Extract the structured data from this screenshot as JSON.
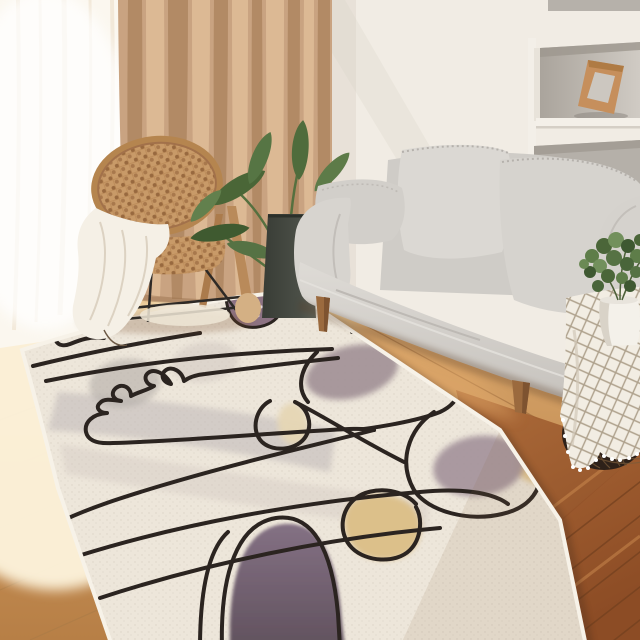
{
  "scene": {
    "type": "living-room photograph",
    "subject": "cream abstract line-art area rug in a bright scandinavian living room",
    "lighting": "warm daylight from a window on the left"
  },
  "palette": {
    "wall": "#f1ece4",
    "niche_interior": "#b5b0a9",
    "frame_wood": "#c68f5c",
    "sheer_curtain": "#fbf7ef",
    "curtain_base": "#c9a381",
    "curtain_fold_dark": "#b08863",
    "curtain_fold_light": "#e0bd98",
    "floor_light_wood": "#cf9e66",
    "floor_sunlit": "#f9ebcb",
    "floor_red_wood": "#9e5c30",
    "rug_base": "#ede6da",
    "rug_line_black": "#2b2420",
    "rug_gray_band": "#beb6b6",
    "rug_mauve": "#9e8d94",
    "rug_purple_dome": "#75646f",
    "rug_yellow": "#dcc08a",
    "rug_cream_oval": "#e6d6b4",
    "sofa_fabric": "#d6d3ce",
    "sofa_leg_wood": "#9b6a3e",
    "blanket_white": "#f5f0e6",
    "rattan": "#c89a68",
    "plant_green": "#4f6c3c",
    "planter_dark": "#43473f",
    "gingham_cloth": "#f2ede3",
    "gingham_line": "#8f7d64",
    "basket_dark": "#2e2119",
    "pot_white": "#f4f1ea"
  },
  "objects": [
    {
      "name": "sheer-curtain",
      "label": "white sheer curtain over bright window"
    },
    {
      "name": "curtain",
      "label": "tan floor-length curtain"
    },
    {
      "name": "wall-niches",
      "label": "recessed white wall shelves with gray interiors"
    },
    {
      "name": "picture-frame",
      "label": "empty wooden frame leaning in middle niche"
    },
    {
      "name": "rattan-chair",
      "label": "round-back woven rattan chair"
    },
    {
      "name": "throw-blanket",
      "label": "white chunky throw draped over chair to floor"
    },
    {
      "name": "potted-plant-large",
      "label": "philodendron in tall dark planter beside sofa"
    },
    {
      "name": "sofa",
      "label": "light gray two-seat fabric sofa with tapered wood legs"
    },
    {
      "name": "side-table",
      "label": "dark wire basket table with white checked cloth"
    },
    {
      "name": "potted-plant-small",
      "label": "small green bush in white pot on table"
    },
    {
      "name": "area-rug",
      "label": "cream rug: black one-line doodles, gray band, mauve/purple blobs, yellow blobs, dotted arch"
    },
    {
      "name": "wood-floor",
      "label": "pale sunlit oak floor at left, red-brown planks at right"
    }
  ]
}
